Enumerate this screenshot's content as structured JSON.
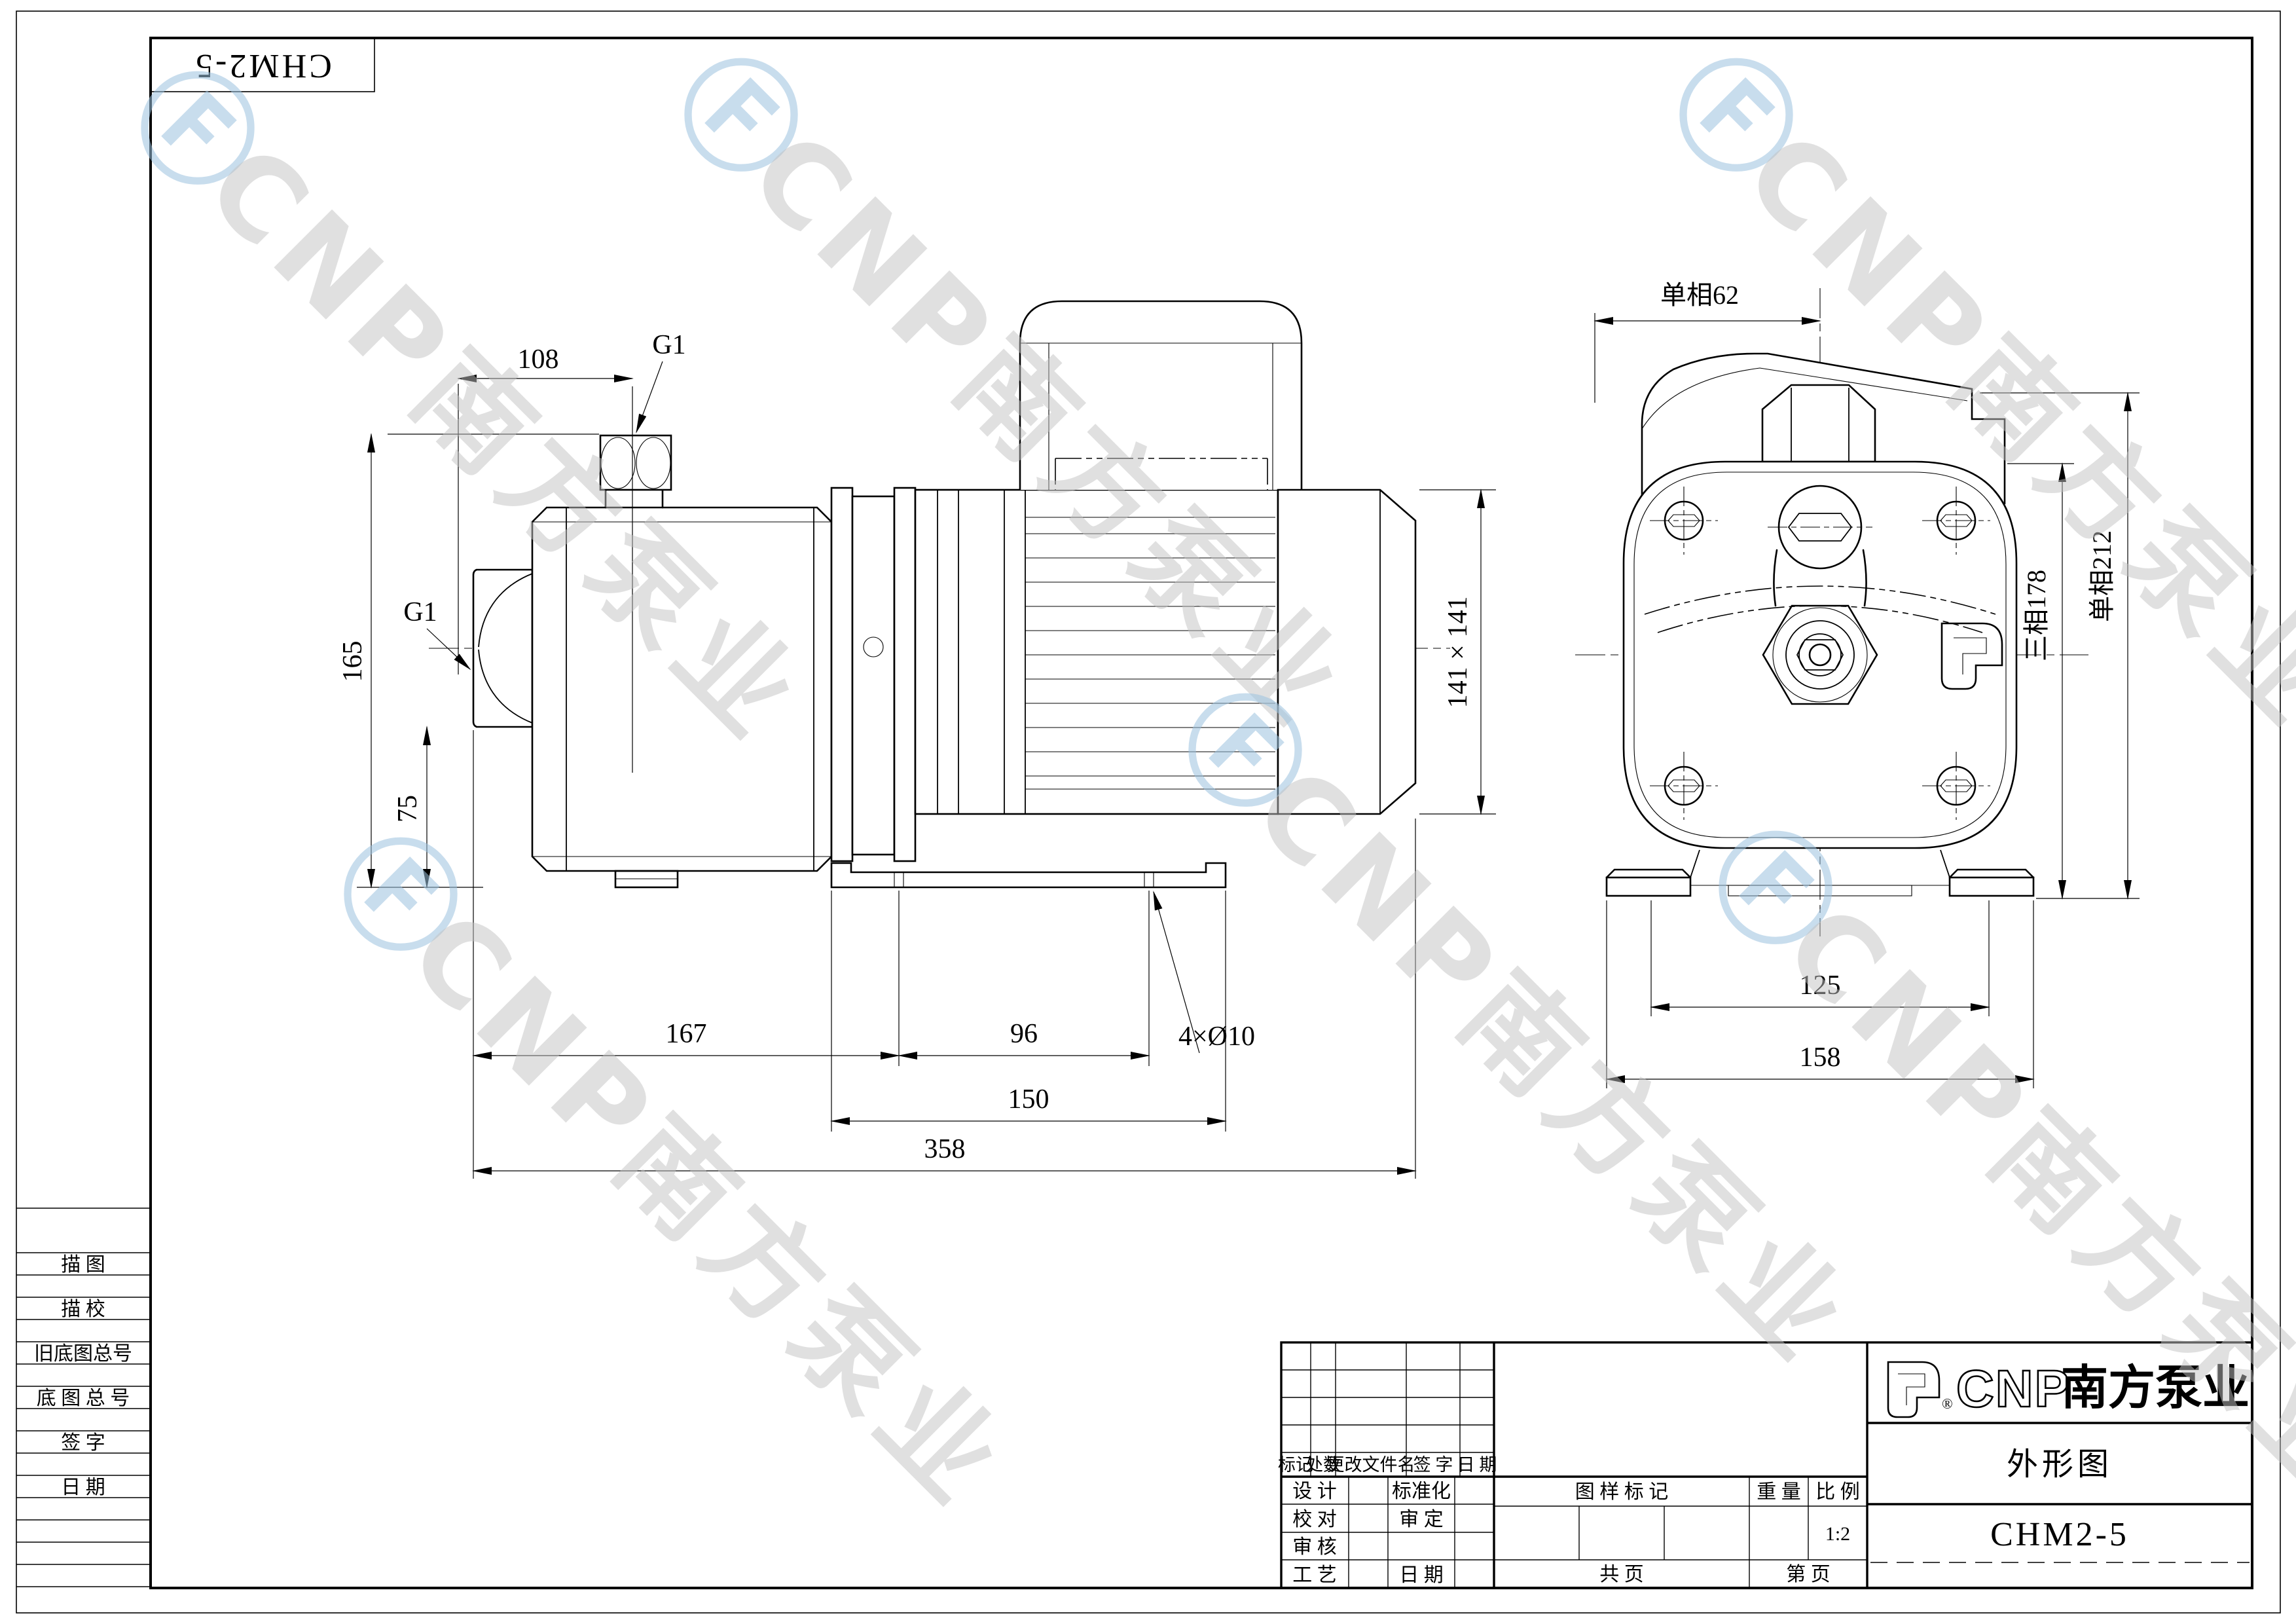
{
  "frame": {
    "part_no_inverted": "CHM2-5"
  },
  "sidebar": {
    "labels": [
      "描  图",
      "描  校",
      "旧底图总号",
      "底 图 总 号",
      "签    字",
      "日    期"
    ]
  },
  "watermark": {
    "glyph": "Ⓕ",
    "text": "CNP南方泵业"
  },
  "side_view": {
    "dims": {
      "top_width": "108",
      "discharge_port": "G1",
      "suction_port": "G1",
      "height_total": "165",
      "suction_height": "75",
      "front_length": "167",
      "foot_span": "96",
      "foot_holes": "4×Ø10",
      "base_length": "150",
      "total_length": "358",
      "motor_square": "141 × 141"
    }
  },
  "end_view": {
    "dims": {
      "single_phase_width": "单相62",
      "three_phase_height": "三相178",
      "single_phase_height": "单相212",
      "bolt_span": "125",
      "base_width": "158"
    }
  },
  "title_block": {
    "revision": {
      "headers": [
        "标记",
        "处数",
        "更改文件名",
        "签  字",
        "日  期"
      ]
    },
    "signatures": {
      "design": "设  计",
      "standardize": "标准化",
      "proof": "校  对",
      "approve": "审  定",
      "audit": "审  核",
      "process": "工  艺",
      "date": "日  期"
    },
    "stamp": {
      "drawing_mark": "图  样  标  记",
      "weight": "重  量",
      "scale": "比  例",
      "scale_value": "1:2",
      "total_pages": "共      页",
      "page_no": "第      页"
    },
    "company": {
      "brand": "CNP",
      "name": "南方泵业",
      "reg": "®"
    },
    "drawing_title": "外形图",
    "drawing_no": "CHM2-5"
  }
}
